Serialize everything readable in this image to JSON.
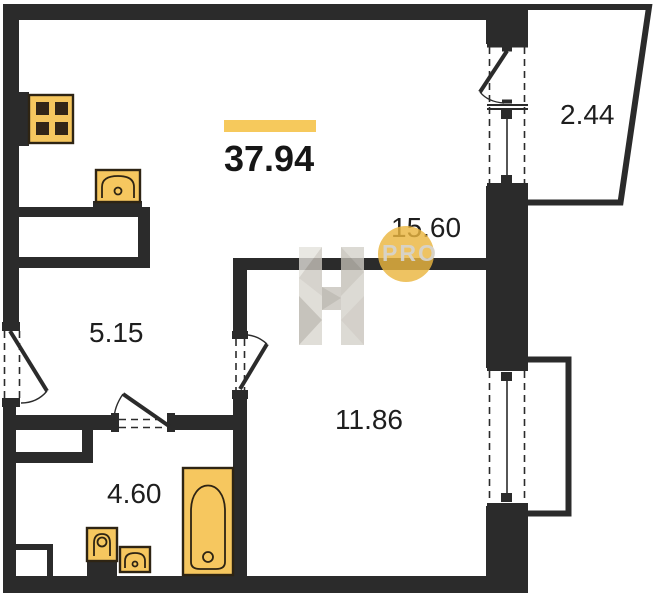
{
  "plan": {
    "type": "apartment-floor-plan",
    "total_area": "37.94",
    "rooms": [
      {
        "name": "living-kitchen",
        "area": "15.60"
      },
      {
        "name": "hallway",
        "area": "5.15"
      },
      {
        "name": "bedroom",
        "area": "11.86"
      },
      {
        "name": "bathroom",
        "area": "4.60"
      },
      {
        "name": "balcony",
        "area": "2.44"
      }
    ],
    "watermark": {
      "brand": "PRO"
    },
    "fixtures": [
      "stove-icon",
      "kitchen-sink-icon",
      "bathtub-icon",
      "toilet-icon",
      "bathroom-sink-icon"
    ],
    "colors": {
      "wall": "#2b2b2b",
      "fixture_fill": "#f6c75f",
      "fixture_stroke": "#2e2413",
      "accent_bar": "#f6c95c",
      "watermark_circle": "#eab63f",
      "watermark_text": "#d6d3cc",
      "label_text": "#1e1e1e"
    }
  }
}
